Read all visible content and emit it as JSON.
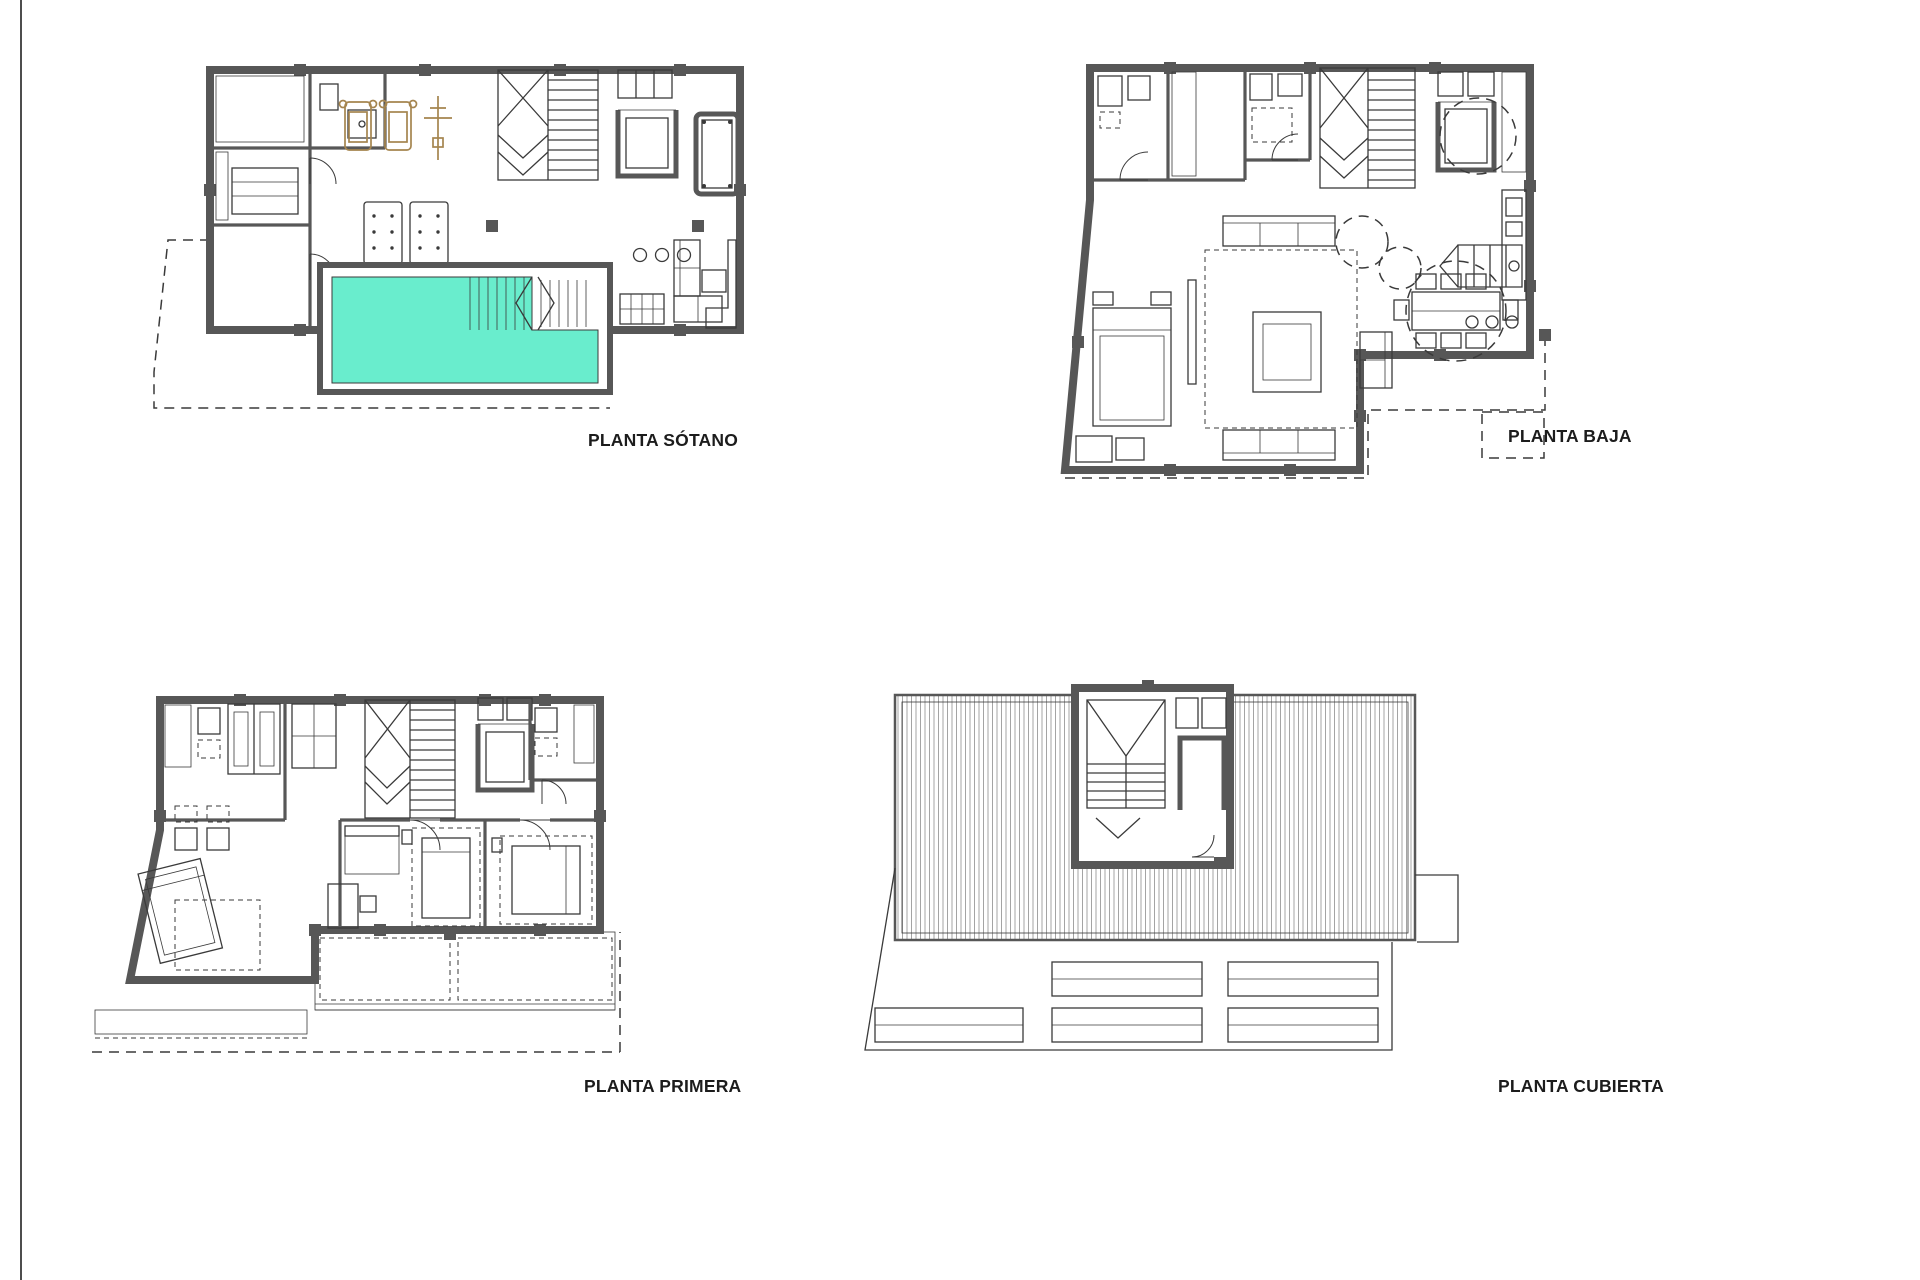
{
  "colors": {
    "wall": "#575757",
    "ink": "#3a3a3a",
    "pool": "#69EDCD",
    "equip": "#a5854f",
    "hatch": "#8f8f8f",
    "label": "#1c1c1c"
  },
  "plans": [
    {
      "id": "sotano",
      "label": "PLANTA SÓTANO"
    },
    {
      "id": "baja",
      "label": "PLANTA BAJA"
    },
    {
      "id": "primera",
      "label": "PLANTA PRIMERA"
    },
    {
      "id": "cubierta",
      "label": "PLANTA CUBIERTA"
    }
  ]
}
